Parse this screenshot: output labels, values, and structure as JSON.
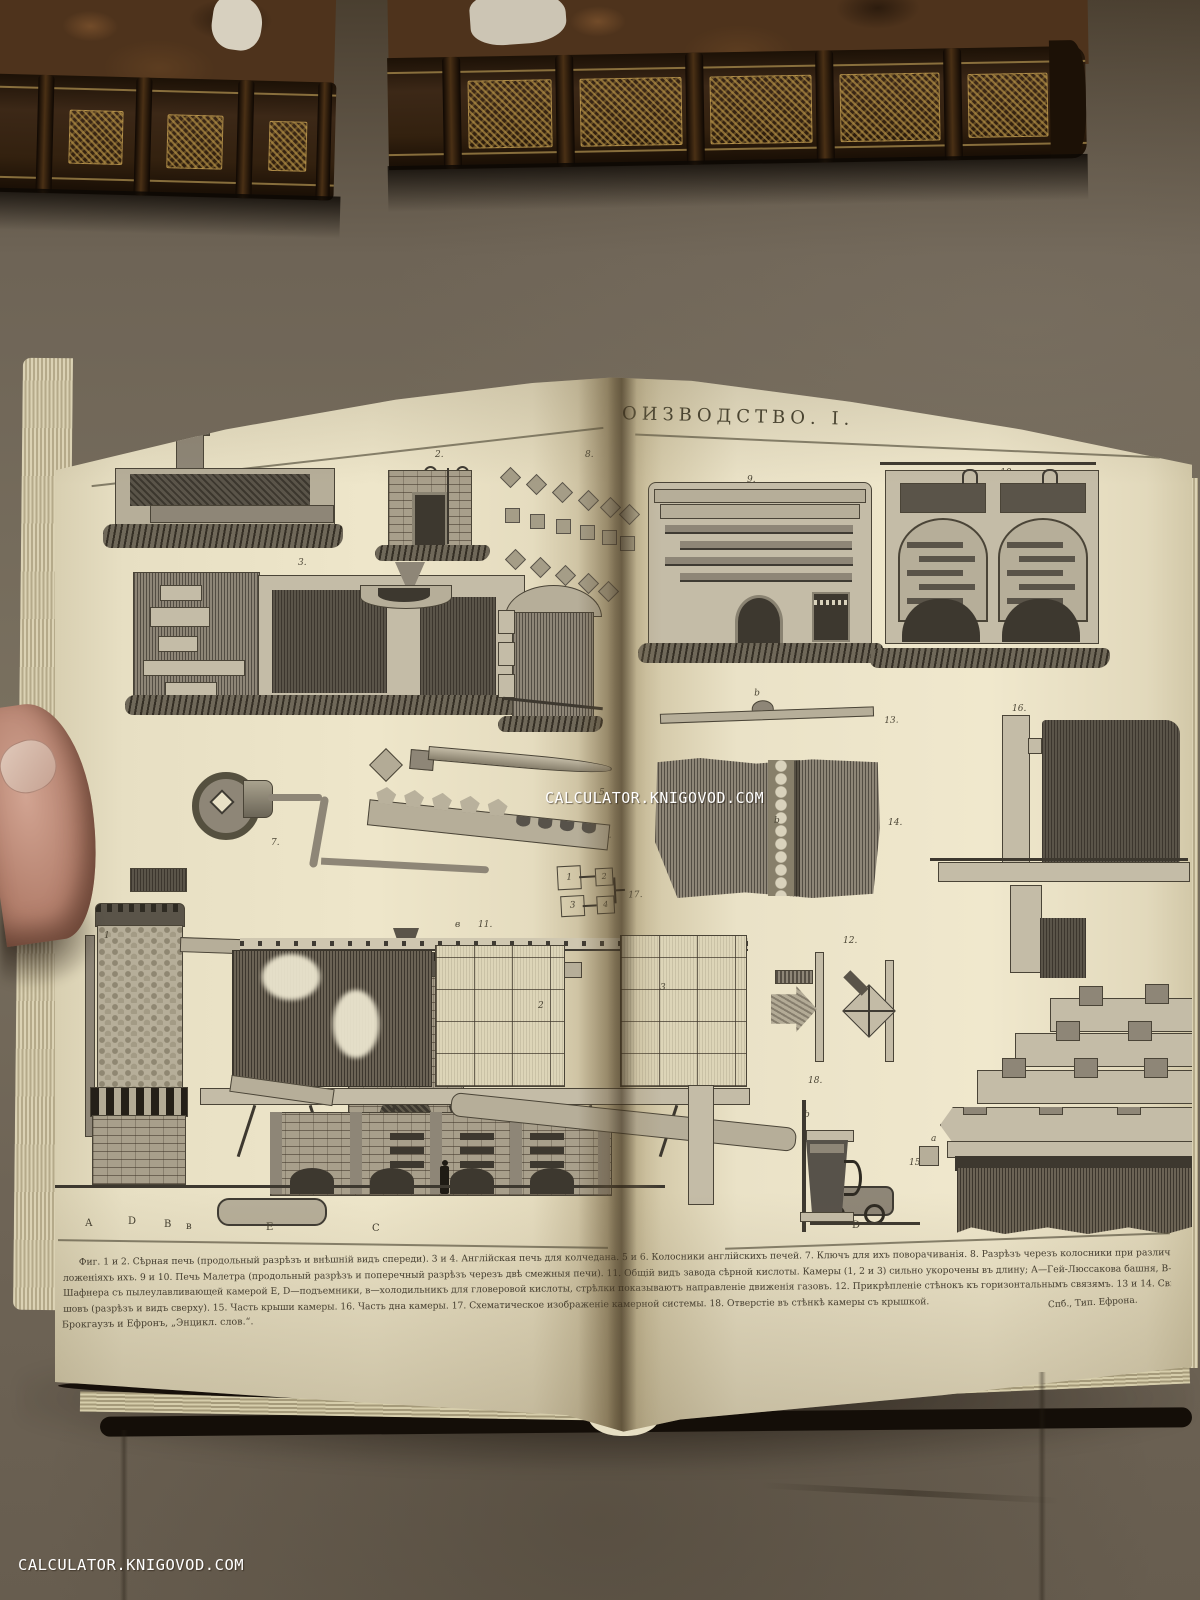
{
  "photo": {
    "watermark_center": "CALCULATOR.KNIGOVOD.COM",
    "watermark_bottom_left": "CALCULATOR.KNIGOVOD.COM"
  },
  "colors": {
    "page_paper": "#ece4c9",
    "backdrop_paper": "#6e6456",
    "book_leather": "#3a2615",
    "gilt": "#a98c4e",
    "ink": "#45402e",
    "watermark_text": "#ffffff"
  },
  "plate": {
    "title_left": "КАМЕРНОЕ",
    "title_right": "ОИЗВОДСТВО. I.",
    "figure_labels": {
      "f1": "1.",
      "f2": "2.",
      "f3": "3.",
      "f4": "4.",
      "f5": "5.",
      "f6": "6.",
      "f7": "7.",
      "f8": "8.",
      "f9": "9.",
      "f10": "10.",
      "f11": "11.",
      "f12": "12.",
      "f13": "13.",
      "f14": "14.",
      "f15": "15.",
      "f16": "16.",
      "f17": "17.",
      "f18": "18."
    },
    "part_labels": {
      "fig11_prefix": "в",
      "tower1": "1",
      "chamber2": "2",
      "chamber3": "3",
      "b13": "b",
      "b14": "b",
      "b18": "b",
      "a15": "a"
    },
    "fig11_letters": [
      "А",
      "D",
      "В",
      "в",
      "Е",
      "С",
      "D"
    ],
    "fig17_boxes": [
      "1",
      "2",
      "3",
      "4"
    ],
    "caption_lines": [
      "Фиг. 1 и 2. Сѣрная печь (продольный разрѣзъ и внѣшній видъ спереди). 3 и 4. Англійская печь для колчедана. 5 и 6. Колосники англійскихъ печей. 7. Ключъ для ихъ поворачиванія. 8. Разрѣзъ черезъ колосники при различныхъ по-",
      "ложеніяхъ ихъ. 9 и 10. Печь Малетра (продольный разрѣзъ и поперечный разрѣзъ черезъ двѣ смежныя печи). 11. Общій видъ завода сѣрной кислоты. Камеры (1, 2 и 3) сильно укорочены въ длину; А—Гей-Люссакова башня, В—Гловерова башня, С—печь",
      "Шафнера съ пылеулавливающей камерой Е, D—подъемники, в—холодильникъ для гловеровой кислоты, стрѣлки показываютъ направленіе движенія газовъ. 12. Прикрѣпленіе стѣнокъ къ горизонтальнымъ связямъ. 13 и 14. Свинцовый",
      "шовъ (разрѣзъ и видъ сверху). 15. Часть крыши камеры. 16. Часть дна камеры. 17. Схематическое изображеніе камерной системы. 18. Отверстіе въ стѣнкѣ камеры съ крышкой."
    ],
    "publisher_left": "Брокгаузъ и Ефронъ, „Энцикл. слов.“.",
    "publisher_right": "Спб., Тип. Ефрона."
  }
}
